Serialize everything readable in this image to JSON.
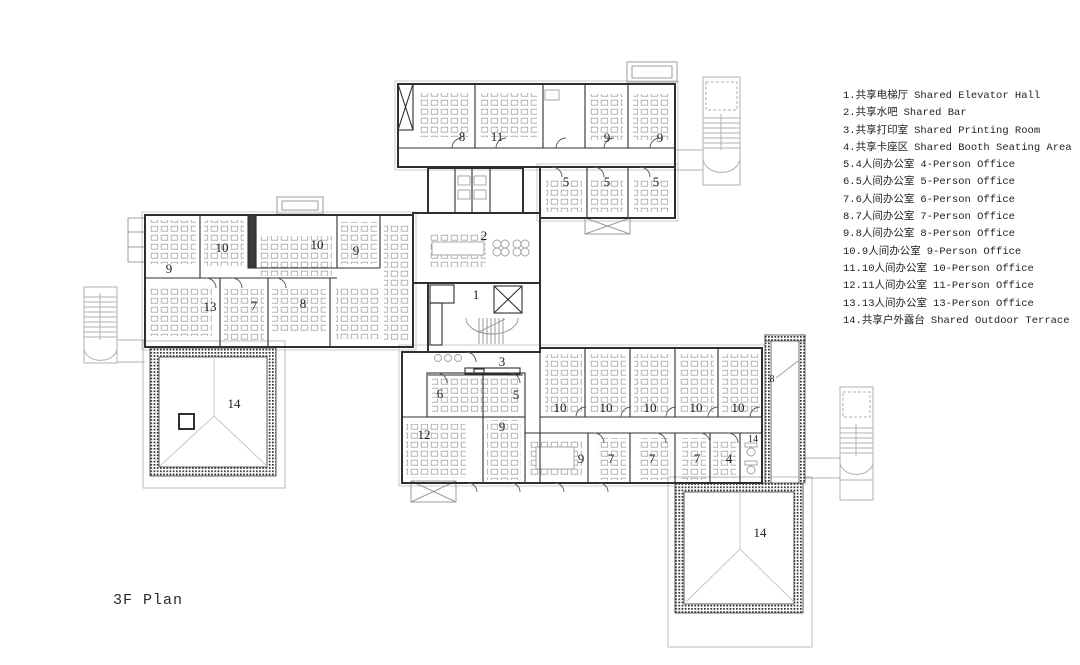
{
  "title": "3F Plan",
  "legend": {
    "items": [
      {
        "num": "1.",
        "zh": "共享电梯厅",
        "en": "Shared Elevator Hall"
      },
      {
        "num": "2.",
        "zh": "共享水吧",
        "en": "Shared Bar"
      },
      {
        "num": "3.",
        "zh": "共享打印室",
        "en": "Shared Printing Room"
      },
      {
        "num": "4.",
        "zh": "共享卡座区",
        "en": "Shared Booth Seating Area"
      },
      {
        "num": "5.",
        "zh": "4人间办公室",
        "en": "4-Person Office"
      },
      {
        "num": "6.",
        "zh": "5人间办公室",
        "en": "5-Person Office"
      },
      {
        "num": "7.",
        "zh": "6人间办公室",
        "en": "6-Person Office"
      },
      {
        "num": "8.",
        "zh": "7人间办公室",
        "en": "7-Person Office"
      },
      {
        "num": "9.",
        "zh": "8人间办公室",
        "en": "8-Person Office"
      },
      {
        "num": "10.",
        "zh": "9人间办公室",
        "en": "9-Person Office"
      },
      {
        "num": "11.",
        "zh": "10人间办公室",
        "en": "10-Person Office"
      },
      {
        "num": "12.",
        "zh": "11人间办公室",
        "en": "11-Person Office"
      },
      {
        "num": "13.",
        "zh": "13人间办公室",
        "en": "13-Person Office"
      },
      {
        "num": "14.",
        "zh": "共享户外露台",
        "en": "Shared Outdoor Terrace"
      }
    ]
  },
  "plan": {
    "labels": [
      "8",
      "11",
      "9",
      "9",
      "5",
      "5",
      "5",
      "10",
      "10",
      "9",
      "9",
      "13",
      "7",
      "8",
      "2",
      "1",
      "3",
      "6",
      "5",
      "12",
      "9",
      "10",
      "10",
      "10",
      "10",
      "10",
      "9",
      "7",
      "7",
      "7",
      "4",
      "14",
      "8",
      "14",
      "14"
    ]
  }
}
